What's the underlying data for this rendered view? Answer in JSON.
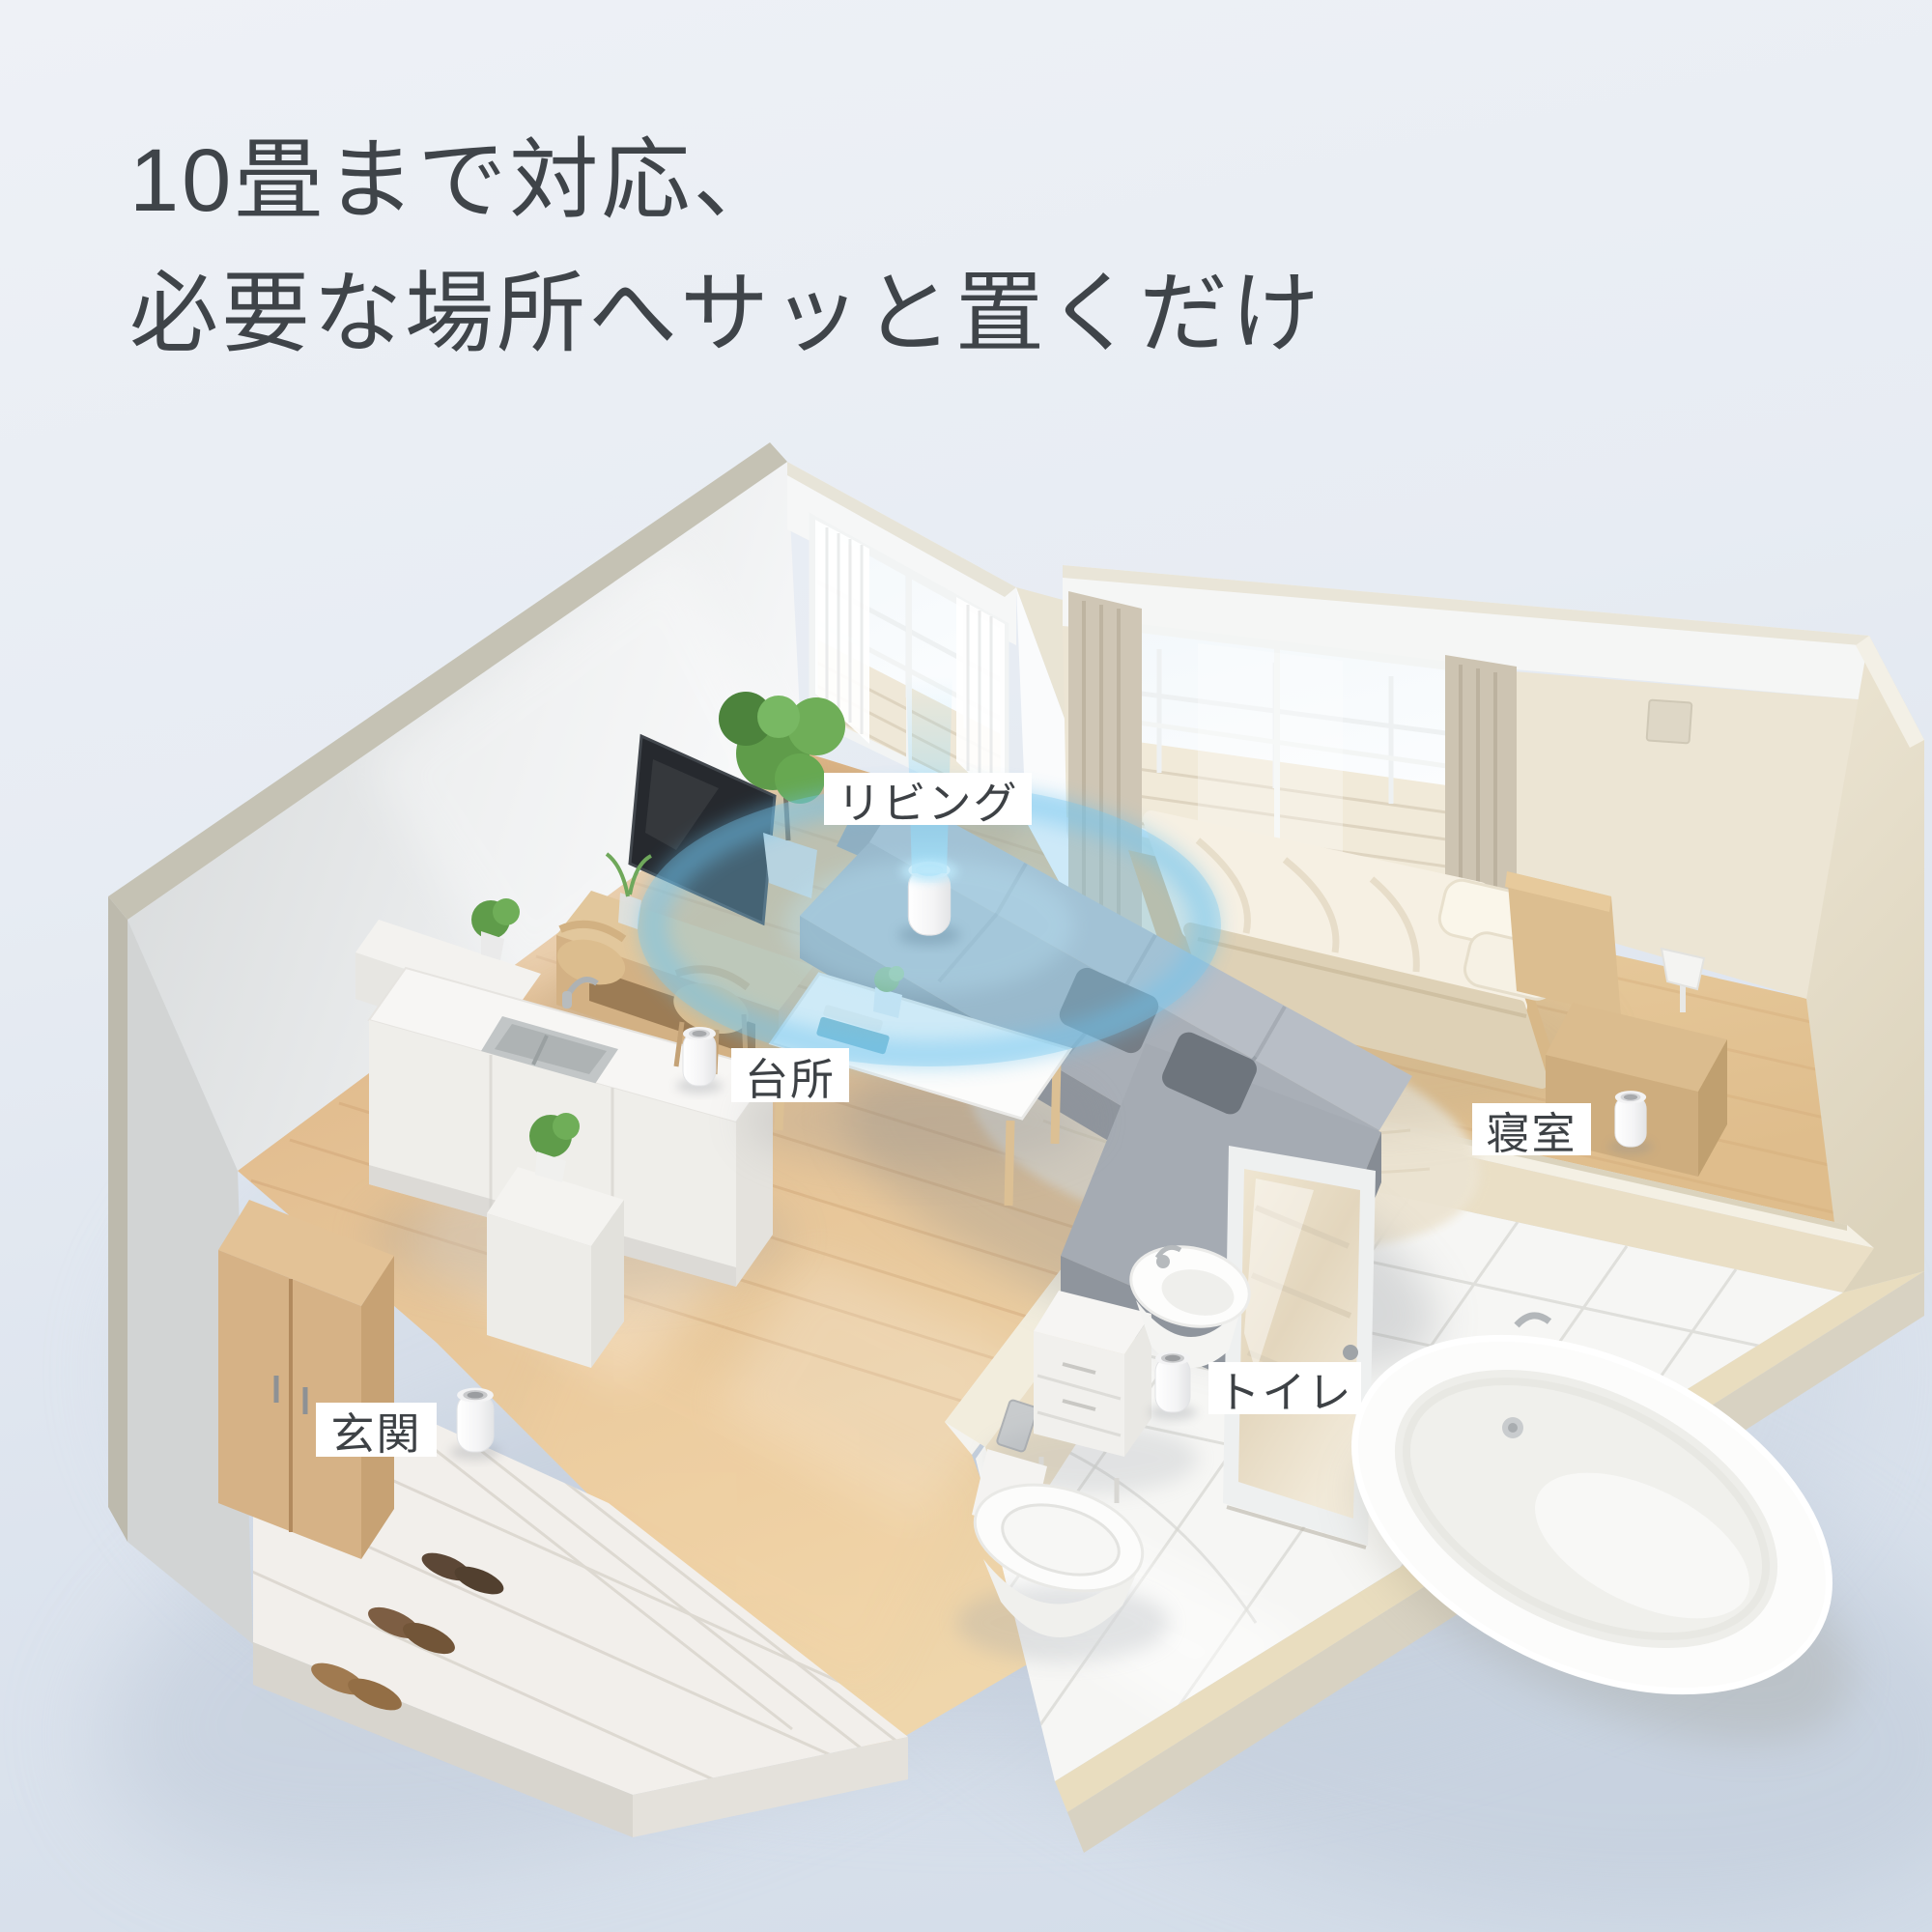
{
  "title": {
    "line1": "10畳まで対応、",
    "line2": "必要な場所へサッと置くだけ"
  },
  "labels": {
    "living": "リビング",
    "kitchen": "台所",
    "bedroom": "寝室",
    "toilet": "トイレ",
    "entrance": "玄関"
  },
  "colors": {
    "background_top": "#eef1f6",
    "background_bottom": "#d2dce8",
    "title_text": "#3f4449",
    "label_background": "#ffffff",
    "label_text": "#3d4145",
    "accent_blue": "#76c7ee",
    "wood_floor": "#e3c092",
    "wall_white": "#f4f5f6",
    "wall_beige": "#eadfc6"
  }
}
